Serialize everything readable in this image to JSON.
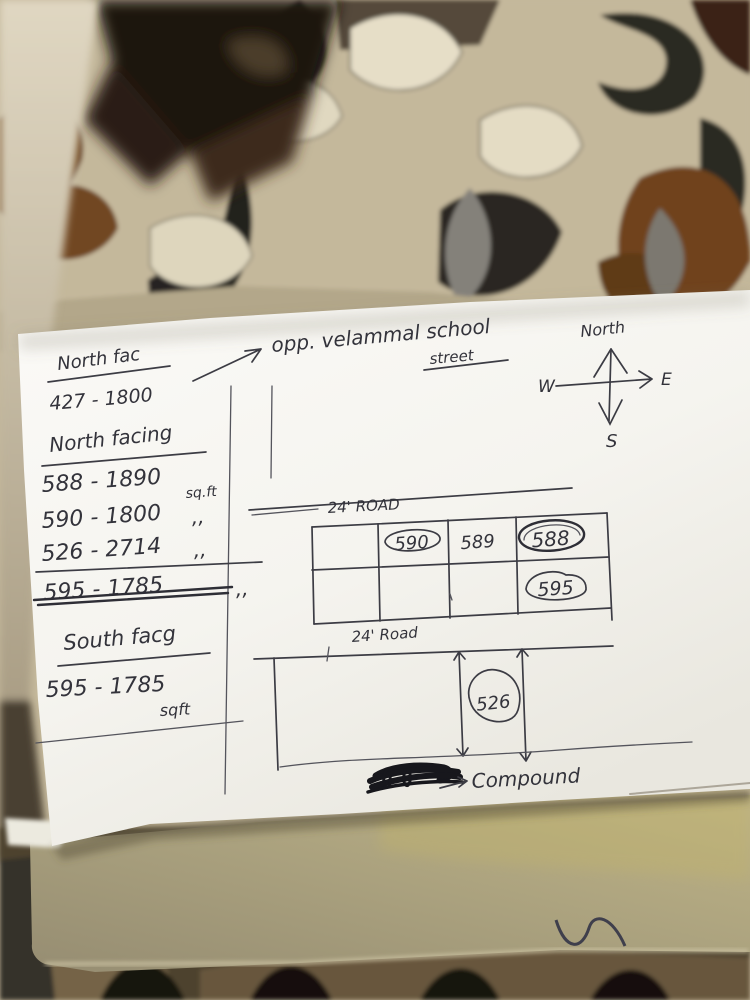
{
  "photo_scene": {
    "colors": {
      "ink": "#33333b",
      "paper": "#f8f7f3",
      "board": "#aca179",
      "fabric_base": "#c4b89b",
      "fabric_brown": "#6b4118",
      "fabric_dark": "#2a2824"
    },
    "paper_note": {
      "header": {
        "label": "North fac",
        "value": "427 - 1800"
      },
      "pointer_note": {
        "line1": "opp. velammal school",
        "line2": "street"
      },
      "compass": {
        "north": "North",
        "west": "W",
        "east": "E",
        "south": "S"
      },
      "north_facing": {
        "heading": "North facing",
        "rows": [
          {
            "label": "588 - 1890",
            "unit": "sq.ft",
            "struck": false
          },
          {
            "label": "590 - 1800",
            "unit": ",,",
            "struck": false
          },
          {
            "label": "526 - 2714",
            "unit": ",,",
            "struck": false
          },
          {
            "label": "595 - 1785",
            "unit": ",,",
            "struck": true
          }
        ]
      },
      "south_facing": {
        "heading": "South facg",
        "label": "595 - 1785",
        "unit": "sqft"
      },
      "site_plan": {
        "top_road_label": "24' ROAD",
        "middle_road_label": "24' Road",
        "plots": {
          "p590": "590",
          "p589": "589",
          "p588": "588",
          "p595": "595",
          "p526": "526"
        },
        "compound_label": "Compound"
      }
    }
  }
}
